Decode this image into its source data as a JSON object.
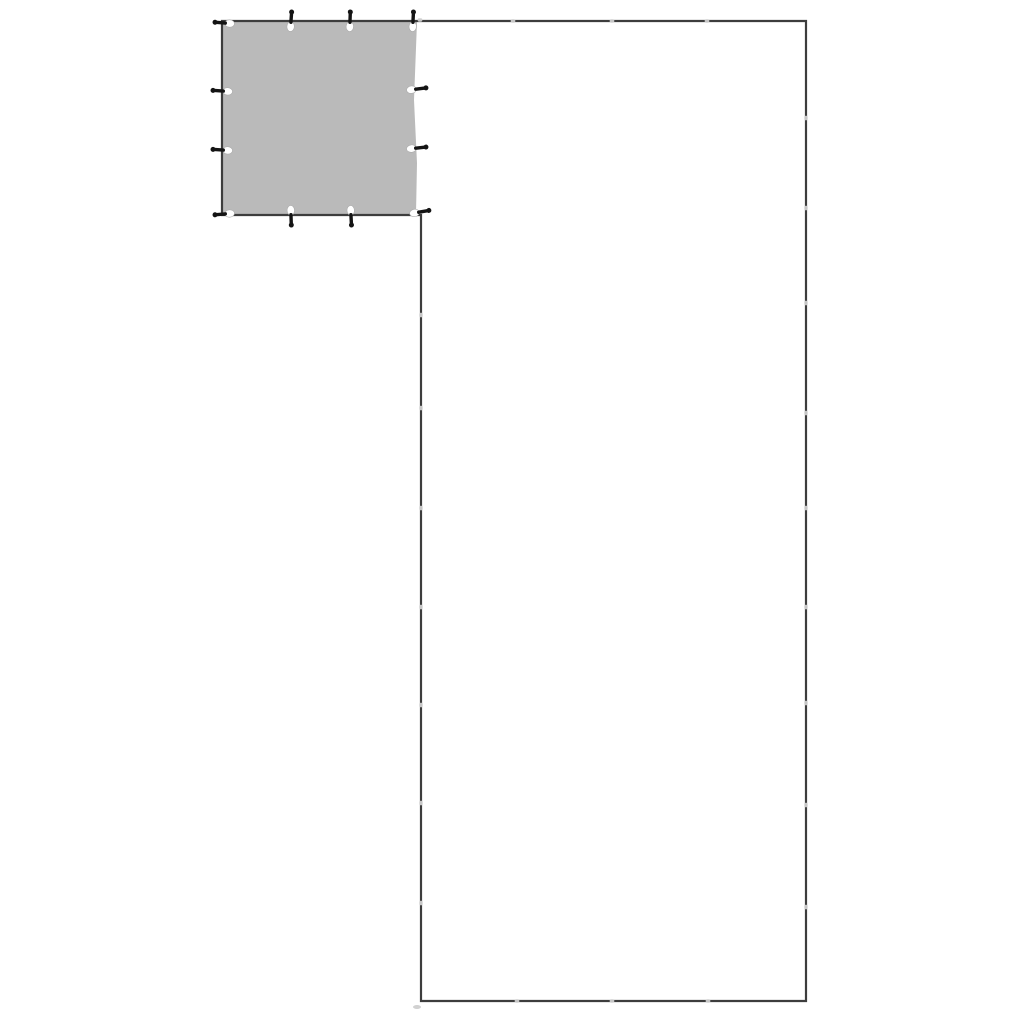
{
  "canvas": {
    "width": 1024,
    "height": 1024,
    "background": "#ffffff"
  },
  "colors": {
    "outline": "#3d3d3d",
    "tarp_fill": "#bababa",
    "peg": "#141414",
    "eyelet": "#ffffff",
    "eyelet_edge": "#ababab",
    "connector": "#cdcdcd",
    "smudge": "#c6c6c6"
  },
  "outline": {
    "stroke_width": 2.2,
    "points": [
      [
        222,
        21
      ],
      [
        806,
        21
      ],
      [
        806,
        1001
      ],
      [
        421,
        1001
      ],
      [
        421,
        215
      ],
      [
        222,
        215
      ]
    ]
  },
  "tarp": {
    "points": [
      [
        223,
        22
      ],
      [
        417,
        22
      ],
      [
        414,
        100
      ],
      [
        417,
        163
      ],
      [
        416,
        214
      ],
      [
        223,
        214
      ]
    ]
  },
  "pegs": {
    "stake_length": 12.5,
    "stake_thickness": 3.4,
    "head_radius": 2.5,
    "eyelet_rx": 4.9,
    "eyelet_ry": 3.7,
    "items": [
      {
        "x": 224,
        "y": 23,
        "angle": 5
      },
      {
        "x": 291,
        "y": 21,
        "angle": 94
      },
      {
        "x": 350,
        "y": 21,
        "angle": 92
      },
      {
        "x": 413,
        "y": 21,
        "angle": 93
      },
      {
        "x": 222,
        "y": 91,
        "angle": 4
      },
      {
        "x": 222,
        "y": 150,
        "angle": 4
      },
      {
        "x": 417,
        "y": 89,
        "angle": 173
      },
      {
        "x": 417,
        "y": 148,
        "angle": 174
      },
      {
        "x": 224,
        "y": 214,
        "angle": -5
      },
      {
        "x": 291,
        "y": 216,
        "angle": -92
      },
      {
        "x": 351,
        "y": 216,
        "angle": -93
      },
      {
        "x": 420,
        "y": 212,
        "angle": 170
      }
    ]
  },
  "connectors": {
    "size": 4.6,
    "items": [
      {
        "x": 420,
        "y": 20,
        "o": "h"
      },
      {
        "x": 513,
        "y": 21,
        "o": "h"
      },
      {
        "x": 612,
        "y": 21,
        "o": "h"
      },
      {
        "x": 707,
        "y": 21,
        "o": "h"
      },
      {
        "x": 806,
        "y": 118,
        "o": "v"
      },
      {
        "x": 806,
        "y": 208,
        "o": "v"
      },
      {
        "x": 806,
        "y": 303,
        "o": "v"
      },
      {
        "x": 806,
        "y": 413,
        "o": "v"
      },
      {
        "x": 806,
        "y": 508,
        "o": "v"
      },
      {
        "x": 806,
        "y": 607,
        "o": "v"
      },
      {
        "x": 806,
        "y": 703,
        "o": "v"
      },
      {
        "x": 806,
        "y": 805,
        "o": "v"
      },
      {
        "x": 806,
        "y": 907,
        "o": "v"
      },
      {
        "x": 517,
        "y": 1001,
        "o": "h"
      },
      {
        "x": 612,
        "y": 1001,
        "o": "h"
      },
      {
        "x": 708,
        "y": 1001,
        "o": "h"
      },
      {
        "x": 421,
        "y": 315,
        "o": "v"
      },
      {
        "x": 421,
        "y": 408,
        "o": "v"
      },
      {
        "x": 421,
        "y": 508,
        "o": "v"
      },
      {
        "x": 421,
        "y": 607,
        "o": "v"
      },
      {
        "x": 421,
        "y": 705,
        "o": "v"
      },
      {
        "x": 421,
        "y": 803,
        "o": "v"
      },
      {
        "x": 421,
        "y": 903,
        "o": "v"
      }
    ]
  },
  "smudges": [
    {
      "x": 417,
      "y": 1007,
      "rx": 4,
      "ry": 2
    }
  ]
}
